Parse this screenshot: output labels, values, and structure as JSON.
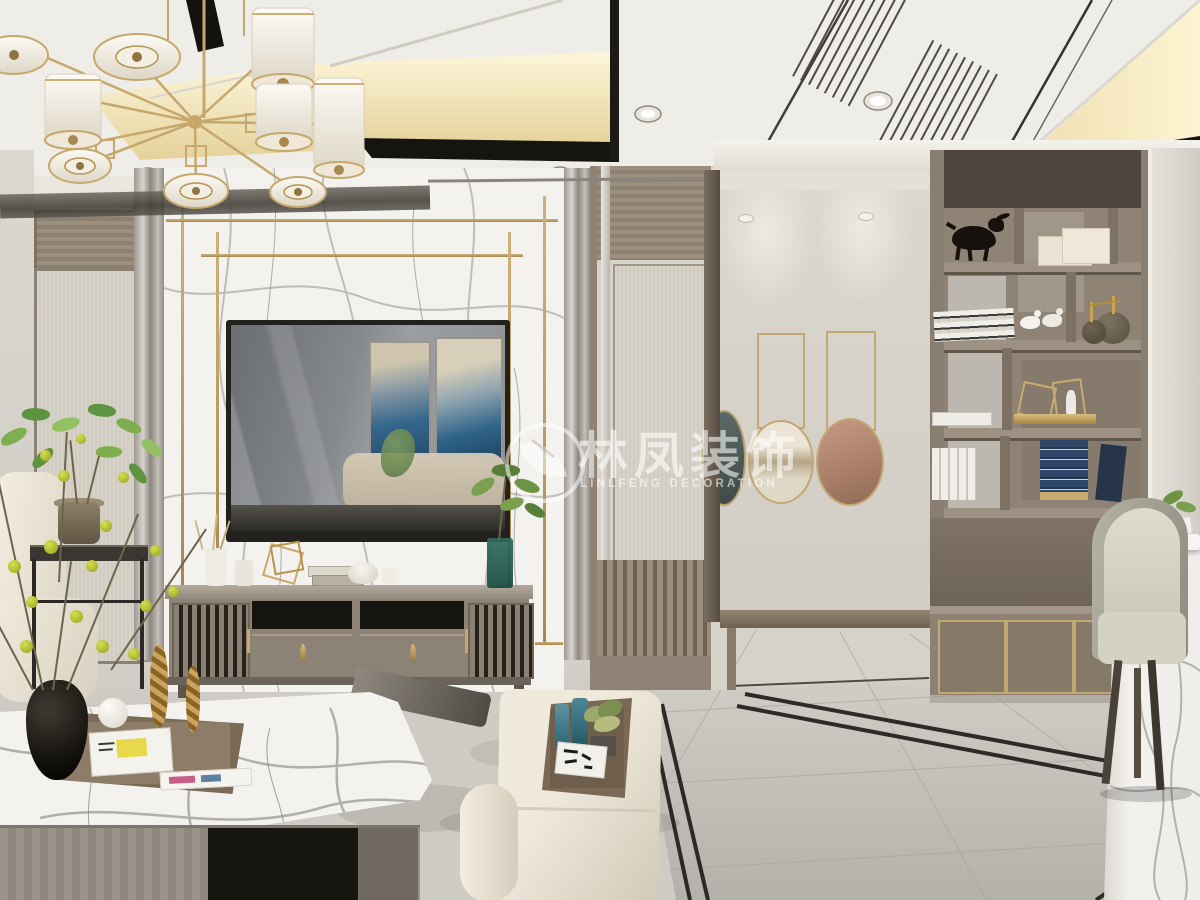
{
  "scene": {
    "type": "interior-design-rendering",
    "room": "living-dining-room",
    "style": "modern-chinese",
    "watermark": {
      "logo": "leaf-swoosh-in-circle",
      "title_cn": "林凤装饰",
      "subtitle_en": "LINLFENG DECORATION"
    }
  },
  "palette": {
    "ceiling_white": "#efede7",
    "cove_light_warm": "#f3e3b2",
    "trim_black": "#17150f",
    "wall_gray": "#d8d4cd",
    "marble_white": "#f3f2ef",
    "gold_accent": "#c2a873",
    "wood_taupe": "#8d8276",
    "fabric_beige": "#d5d0c5",
    "floor_gray": "#c6c3bc",
    "bench_cream": "#ece5d7",
    "accent_teal": "#3f7d8c",
    "berry_yellow": "#c9d13f",
    "art_blue": "#2f6388",
    "plate_copper": "#b98a76"
  },
  "objects": [
    "gold-chandelier",
    "recessed-spotlights",
    "ac-linear-vents",
    "cove-lighting",
    "marble-feature-wall",
    "gold-frame-inlay",
    "wall-mounted-tv",
    "tv-cabinet",
    "partition-screen",
    "hallway",
    "hanging-round-plates",
    "display-shelf",
    "bull-sculpture",
    "books",
    "gold-wire-sculptures",
    "dining-chair",
    "marble-dining-table",
    "cream-bench",
    "wood-serving-tray",
    "coffee-table",
    "white-sofa",
    "plant-side-table",
    "berry-branch-vase",
    "area-rug",
    "black-inlay-floor-borders"
  ]
}
